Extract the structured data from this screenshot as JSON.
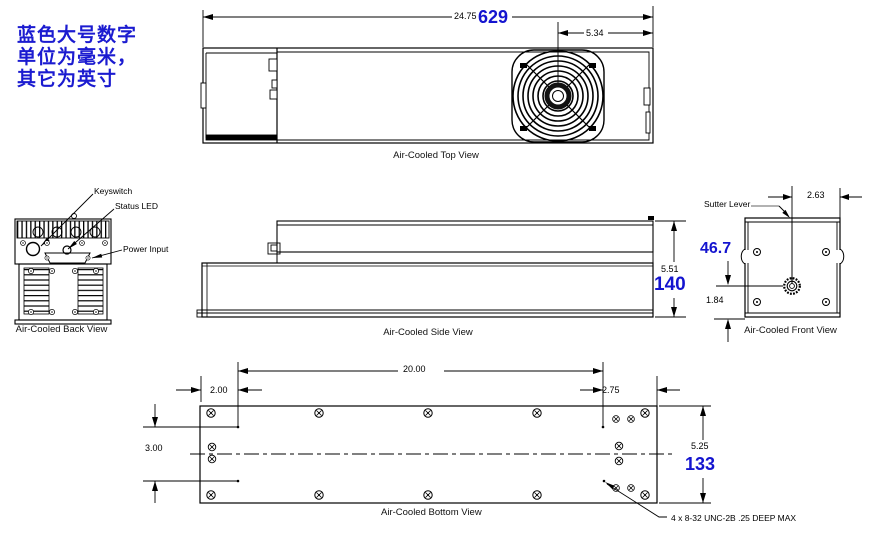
{
  "note": {
    "line1": "蓝色大号数字",
    "line2": "单位为毫米，",
    "line3": "其它为英寸"
  },
  "colors": {
    "accent_blue": "#1414cf",
    "line_black": "#000000"
  },
  "top_view": {
    "caption": "Air-Cooled Top View",
    "length_in": "24.75",
    "length_mm": "629",
    "fan_offset_in": "5.34"
  },
  "back_view": {
    "caption": "Air-Cooled Back View",
    "keyswitch_label": "Keyswitch",
    "status_led_label": "Status LED",
    "power_input_label": "Power Input"
  },
  "side_view": {
    "caption": "Air-Cooled Side View",
    "height_in": "5.51",
    "height_mm": "140"
  },
  "front_view": {
    "caption": "Air-Cooled Front View",
    "shutter_label": "Sutter Lever",
    "offset_in": "2.63",
    "aperture_height_mm": "46.7",
    "aperture_height_in": "1.84"
  },
  "bottom_view": {
    "caption": "Air-Cooled Bottom View",
    "edge_offset_in": "2.00",
    "hole_span_in": "20.00",
    "right_offset_in": "2.75",
    "hole_width_in": "3.00",
    "width_in": "5.25",
    "width_mm": "133",
    "thread_callout": "4 x 8-32 UNC-2B .25 DEEP MAX"
  }
}
